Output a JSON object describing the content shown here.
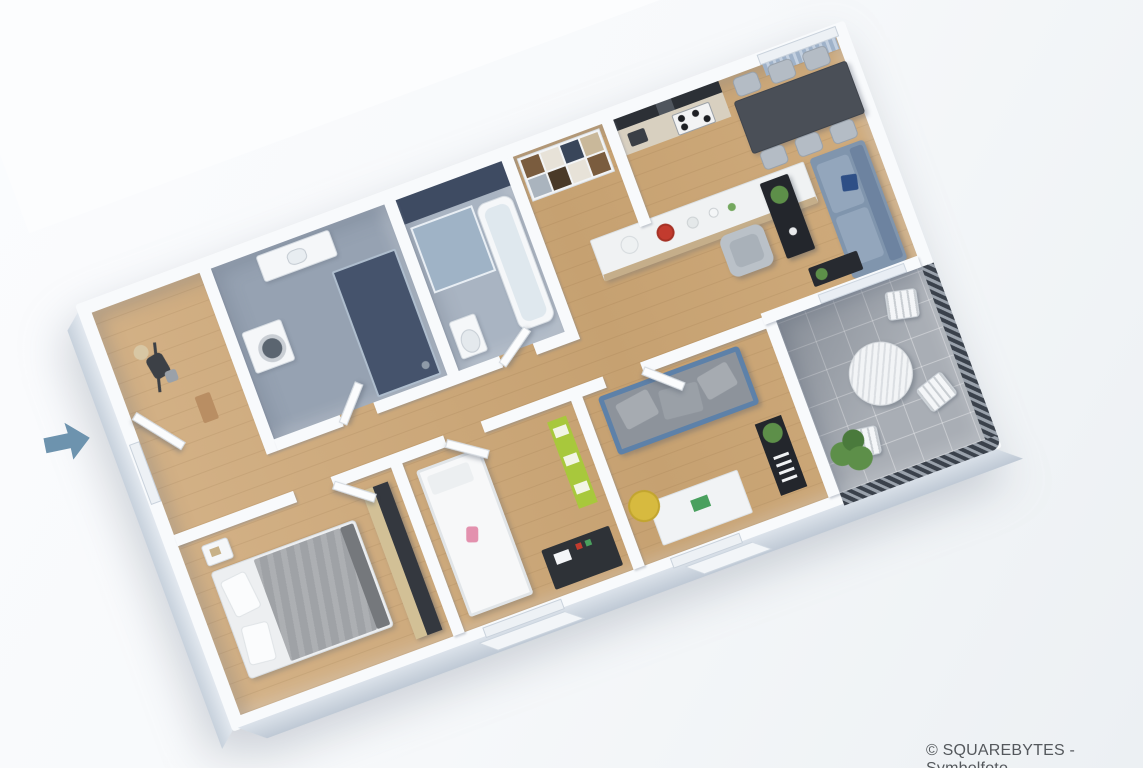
{
  "watermark": {
    "text": "© SQUAREBYTES - Symbolfoto"
  },
  "entrance_arrow": {
    "icon": "arrow-right-icon",
    "direction": "right"
  },
  "colors": {
    "wall": "#f8fafc",
    "wall_shade": "#c7d1dc",
    "wood": "#cead7f",
    "tile_bath": "#96a2b2",
    "tile_bath_dark": "#45536c",
    "tile_bath_light": "#a9b4c2",
    "tile_balcony": "#a9aeb5",
    "railing_dark": "#3a414b",
    "table_dark": "#4a4f57",
    "chair_gray": "#b4bcc5",
    "sofa": "#8095ad",
    "cushion_navy": "#2e4f86",
    "black_furniture": "#23262c",
    "bed_blanket": "#9fa2a6",
    "green_shelf": "#a8c83c",
    "plant": "#5d8f49",
    "yellow_chair": "#d7ba3f",
    "accent_red": "#c23b2e",
    "arrow": "#6d93ae",
    "text": "#54585c"
  },
  "floorplan": {
    "rotation_deg": -20.3,
    "rooms": [
      {
        "id": "entry-hall"
      },
      {
        "id": "bathroom"
      },
      {
        "id": "shower-room"
      },
      {
        "id": "storage-nook"
      },
      {
        "id": "kitchen"
      },
      {
        "id": "dining-area"
      },
      {
        "id": "living-area"
      },
      {
        "id": "bedroom-master"
      },
      {
        "id": "bedroom-kids"
      },
      {
        "id": "bedroom-guest"
      },
      {
        "id": "balcony"
      }
    ],
    "furniture": [
      "coat-rack",
      "entry-door",
      "washing-machine",
      "vanity-sink",
      "walk-in-shower",
      "glass-shower",
      "bathtub",
      "toilet",
      "shelf-unit",
      "kitchen-counter",
      "cooktop",
      "kitchen-island",
      "dining-table",
      "dining-chairs",
      "curtain",
      "sofa",
      "coffee-table",
      "armchair",
      "sideboard",
      "double-bed",
      "nightstand",
      "wardrobe",
      "single-bed",
      "toy-shelf",
      "kids-desk",
      "daybed",
      "desk",
      "desk-chair",
      "bookshelf",
      "balcony-table",
      "balcony-chairs",
      "balcony-plant"
    ]
  }
}
